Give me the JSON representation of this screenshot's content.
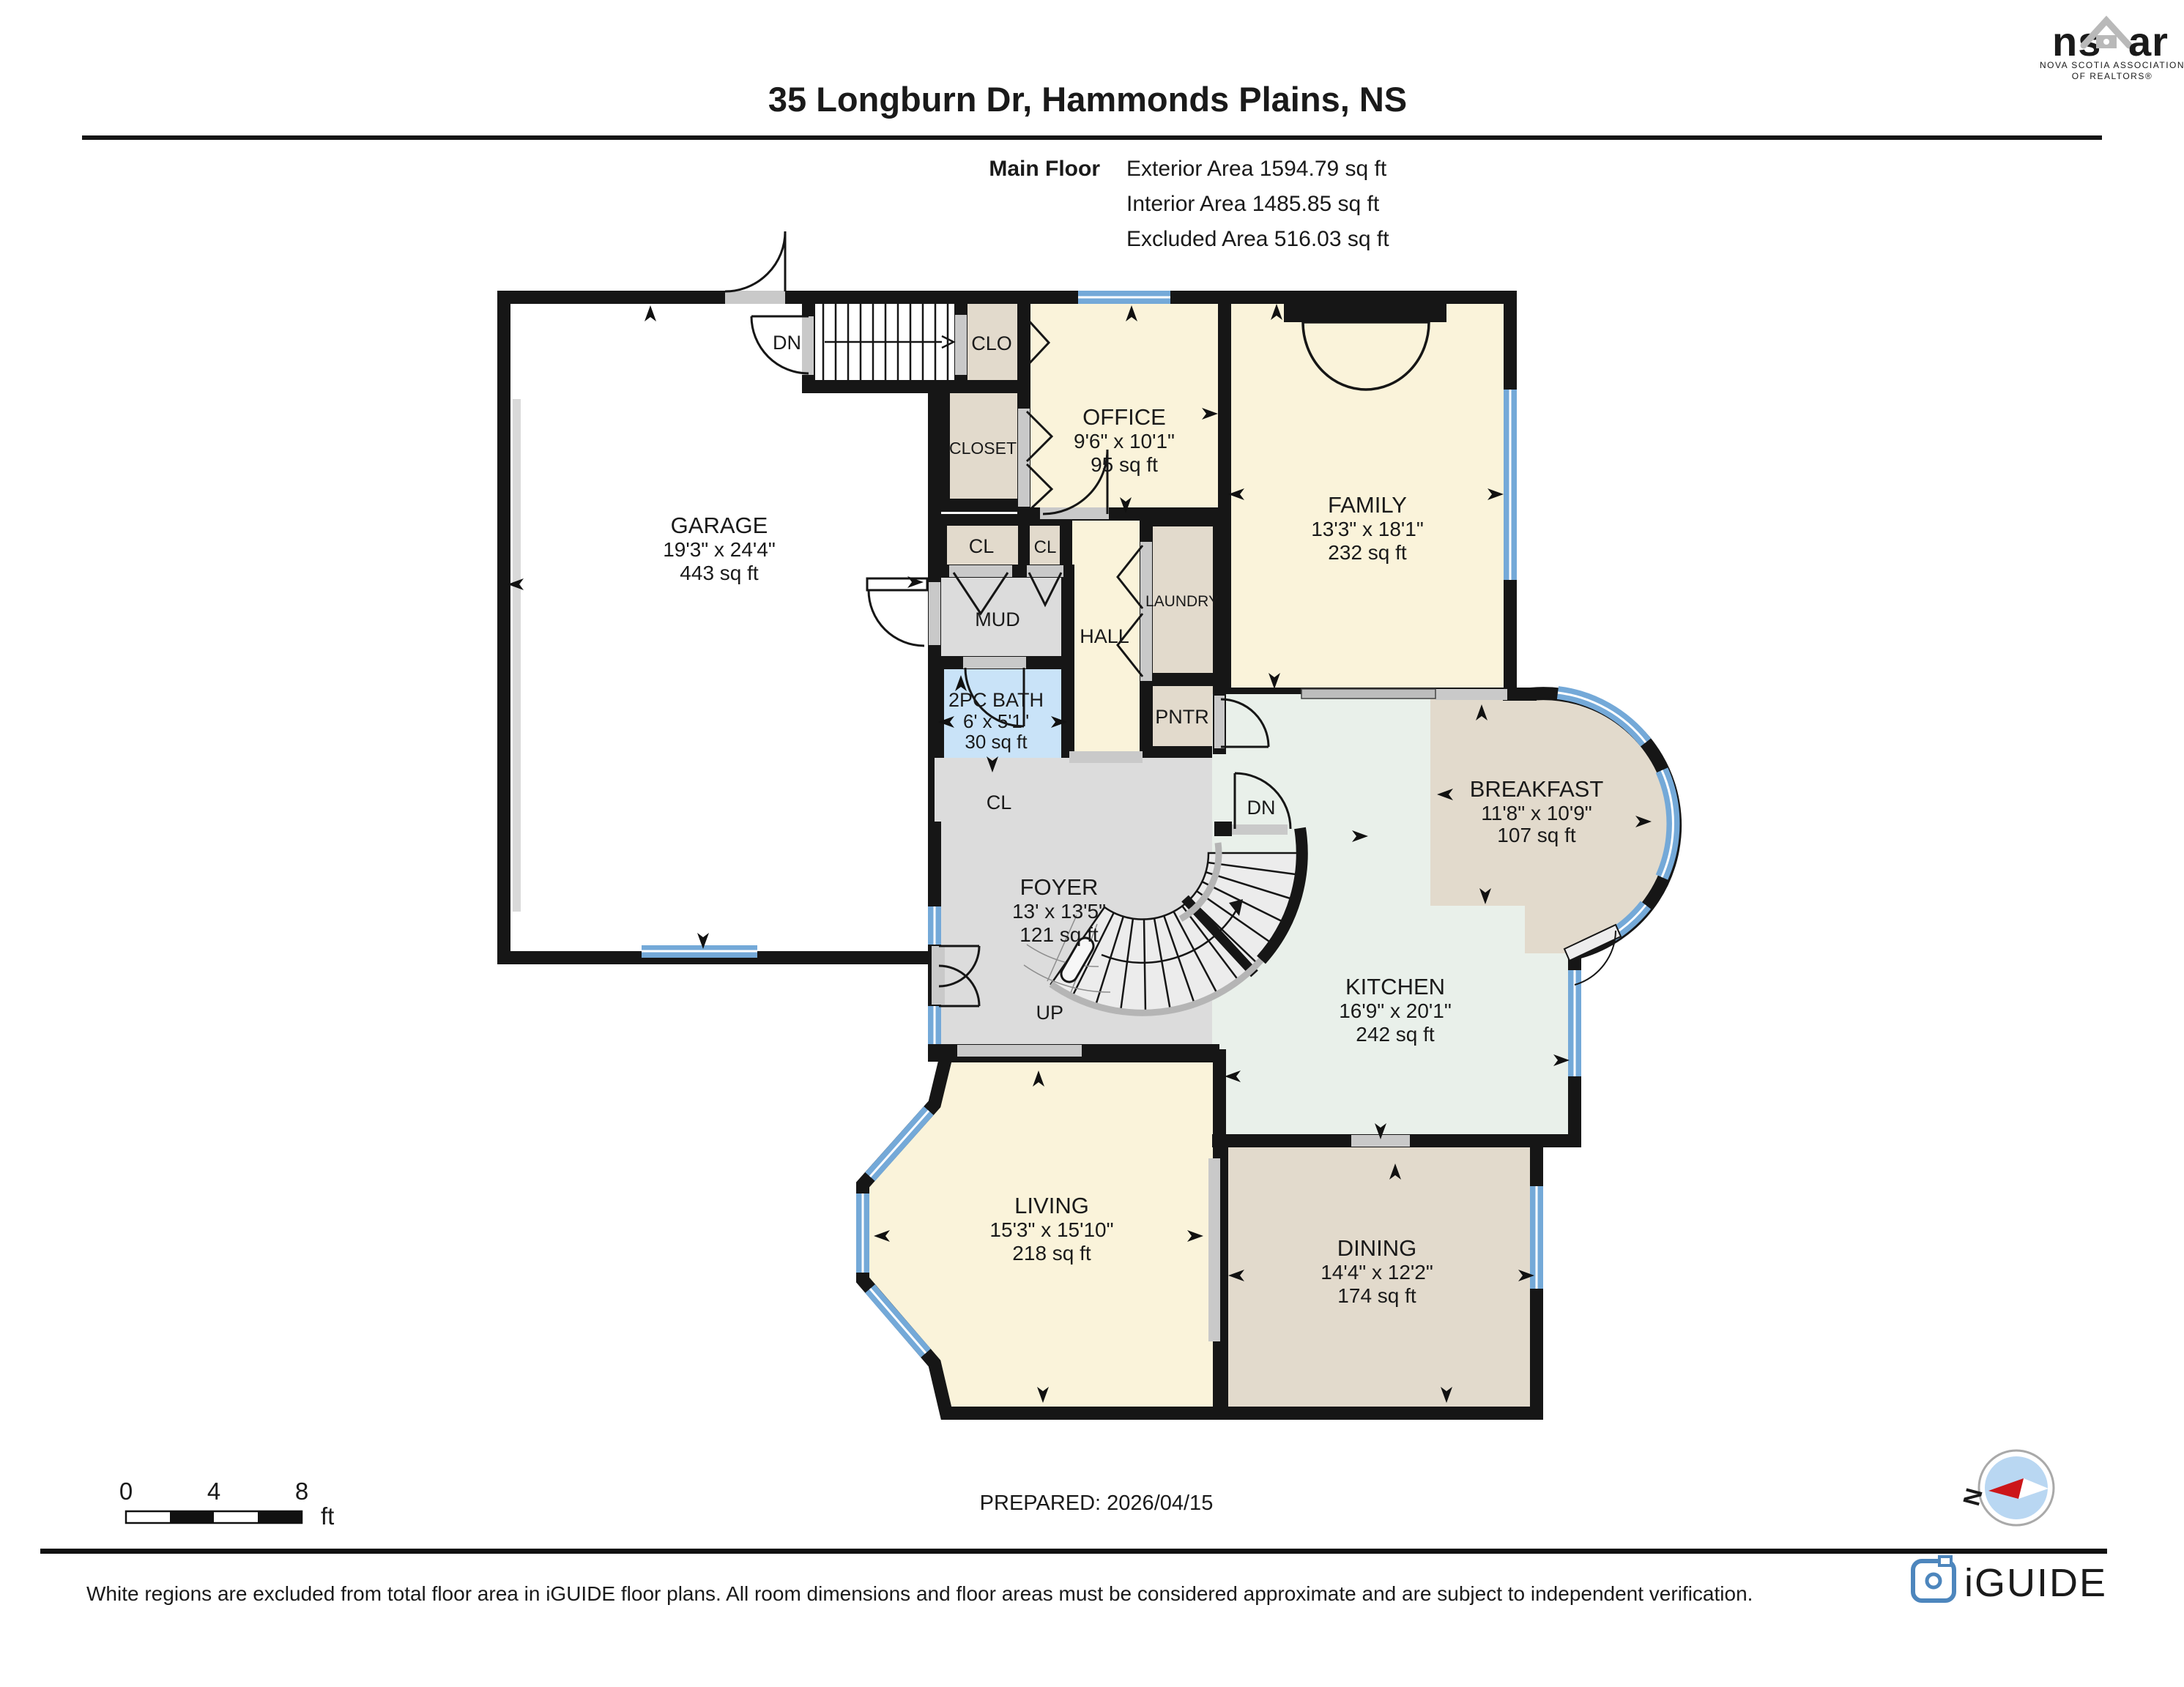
{
  "header": {
    "title": "35 Longburn Dr, Hammonds Plains, NS",
    "floor_label": "Main Floor",
    "stats": [
      "Exterior Area 1594.79 sq ft",
      "Interior Area 1485.85 sq ft",
      "Excluded Area 516.03 sq ft"
    ]
  },
  "rooms": {
    "garage": {
      "name": "GARAGE",
      "dims": "19'3\" x 24'4\"",
      "area": "443 sq ft"
    },
    "office": {
      "name": "OFFICE",
      "dims": "9'6\" x 10'1\"",
      "area": "95 sq ft"
    },
    "family": {
      "name": "FAMILY",
      "dims": "13'3\" x 18'1\"",
      "area": "232 sq ft"
    },
    "breakfast": {
      "name": "BREAKFAST",
      "dims": "11'8\" x 10'9\"",
      "area": "107 sq ft"
    },
    "kitchen": {
      "name": "KITCHEN",
      "dims": "16'9\" x 20'1\"",
      "area": "242 sq ft"
    },
    "foyer": {
      "name": "FOYER",
      "dims": "13' x 13'5\"",
      "area": "121 sq ft"
    },
    "living": {
      "name": "LIVING",
      "dims": "15'3\" x 15'10\"",
      "area": "218 sq ft"
    },
    "dining": {
      "name": "DINING",
      "dims": "14'4\" x 12'2\"",
      "area": "174 sq ft"
    },
    "bath": {
      "name": "2PC BATH",
      "dims": "6' x 5'1\"",
      "area": "30 sq ft"
    },
    "clo": "CLO",
    "closet": "CLOSET",
    "cl_a": "CL",
    "cl_b": "CL",
    "cl_c": "CL",
    "mud": "MUD",
    "hall": "HALL",
    "laundry": "LAUNDRY",
    "pntr": "PNTR"
  },
  "stairs": {
    "dn_top": "DN",
    "dn_mid": "DN",
    "up": "UP"
  },
  "scalebar": {
    "t0": "0",
    "t4": "4",
    "t8": "8",
    "unit": "ft"
  },
  "prepared": "PREPARED: 2026/04/15",
  "compass": {
    "north": "N"
  },
  "footer": {
    "disclaimer": "White regions are excluded from total floor area in iGUIDE floor plans. All room dimensions and floor areas must be considered approximate and are subject to independent verification."
  },
  "branding": {
    "nsar_left": "ns",
    "nsar_right": "ar",
    "nsar_tagline1": "NOVA SCOTIA ASSOCIATION",
    "nsar_tagline2": "OF REALTORS®",
    "iguide": "iGUIDE"
  },
  "colors": {
    "wall": "#161616",
    "window": "#74a9d8",
    "room_yellow": "#faf3da",
    "room_beige": "#e2dacc",
    "room_gray": "#dcdcdc",
    "room_blue": "#c9e3f8",
    "room_green": "#e9f0ea",
    "iguide_blue": "#4d86bd",
    "nsar_gray": "#b9b9b9"
  }
}
